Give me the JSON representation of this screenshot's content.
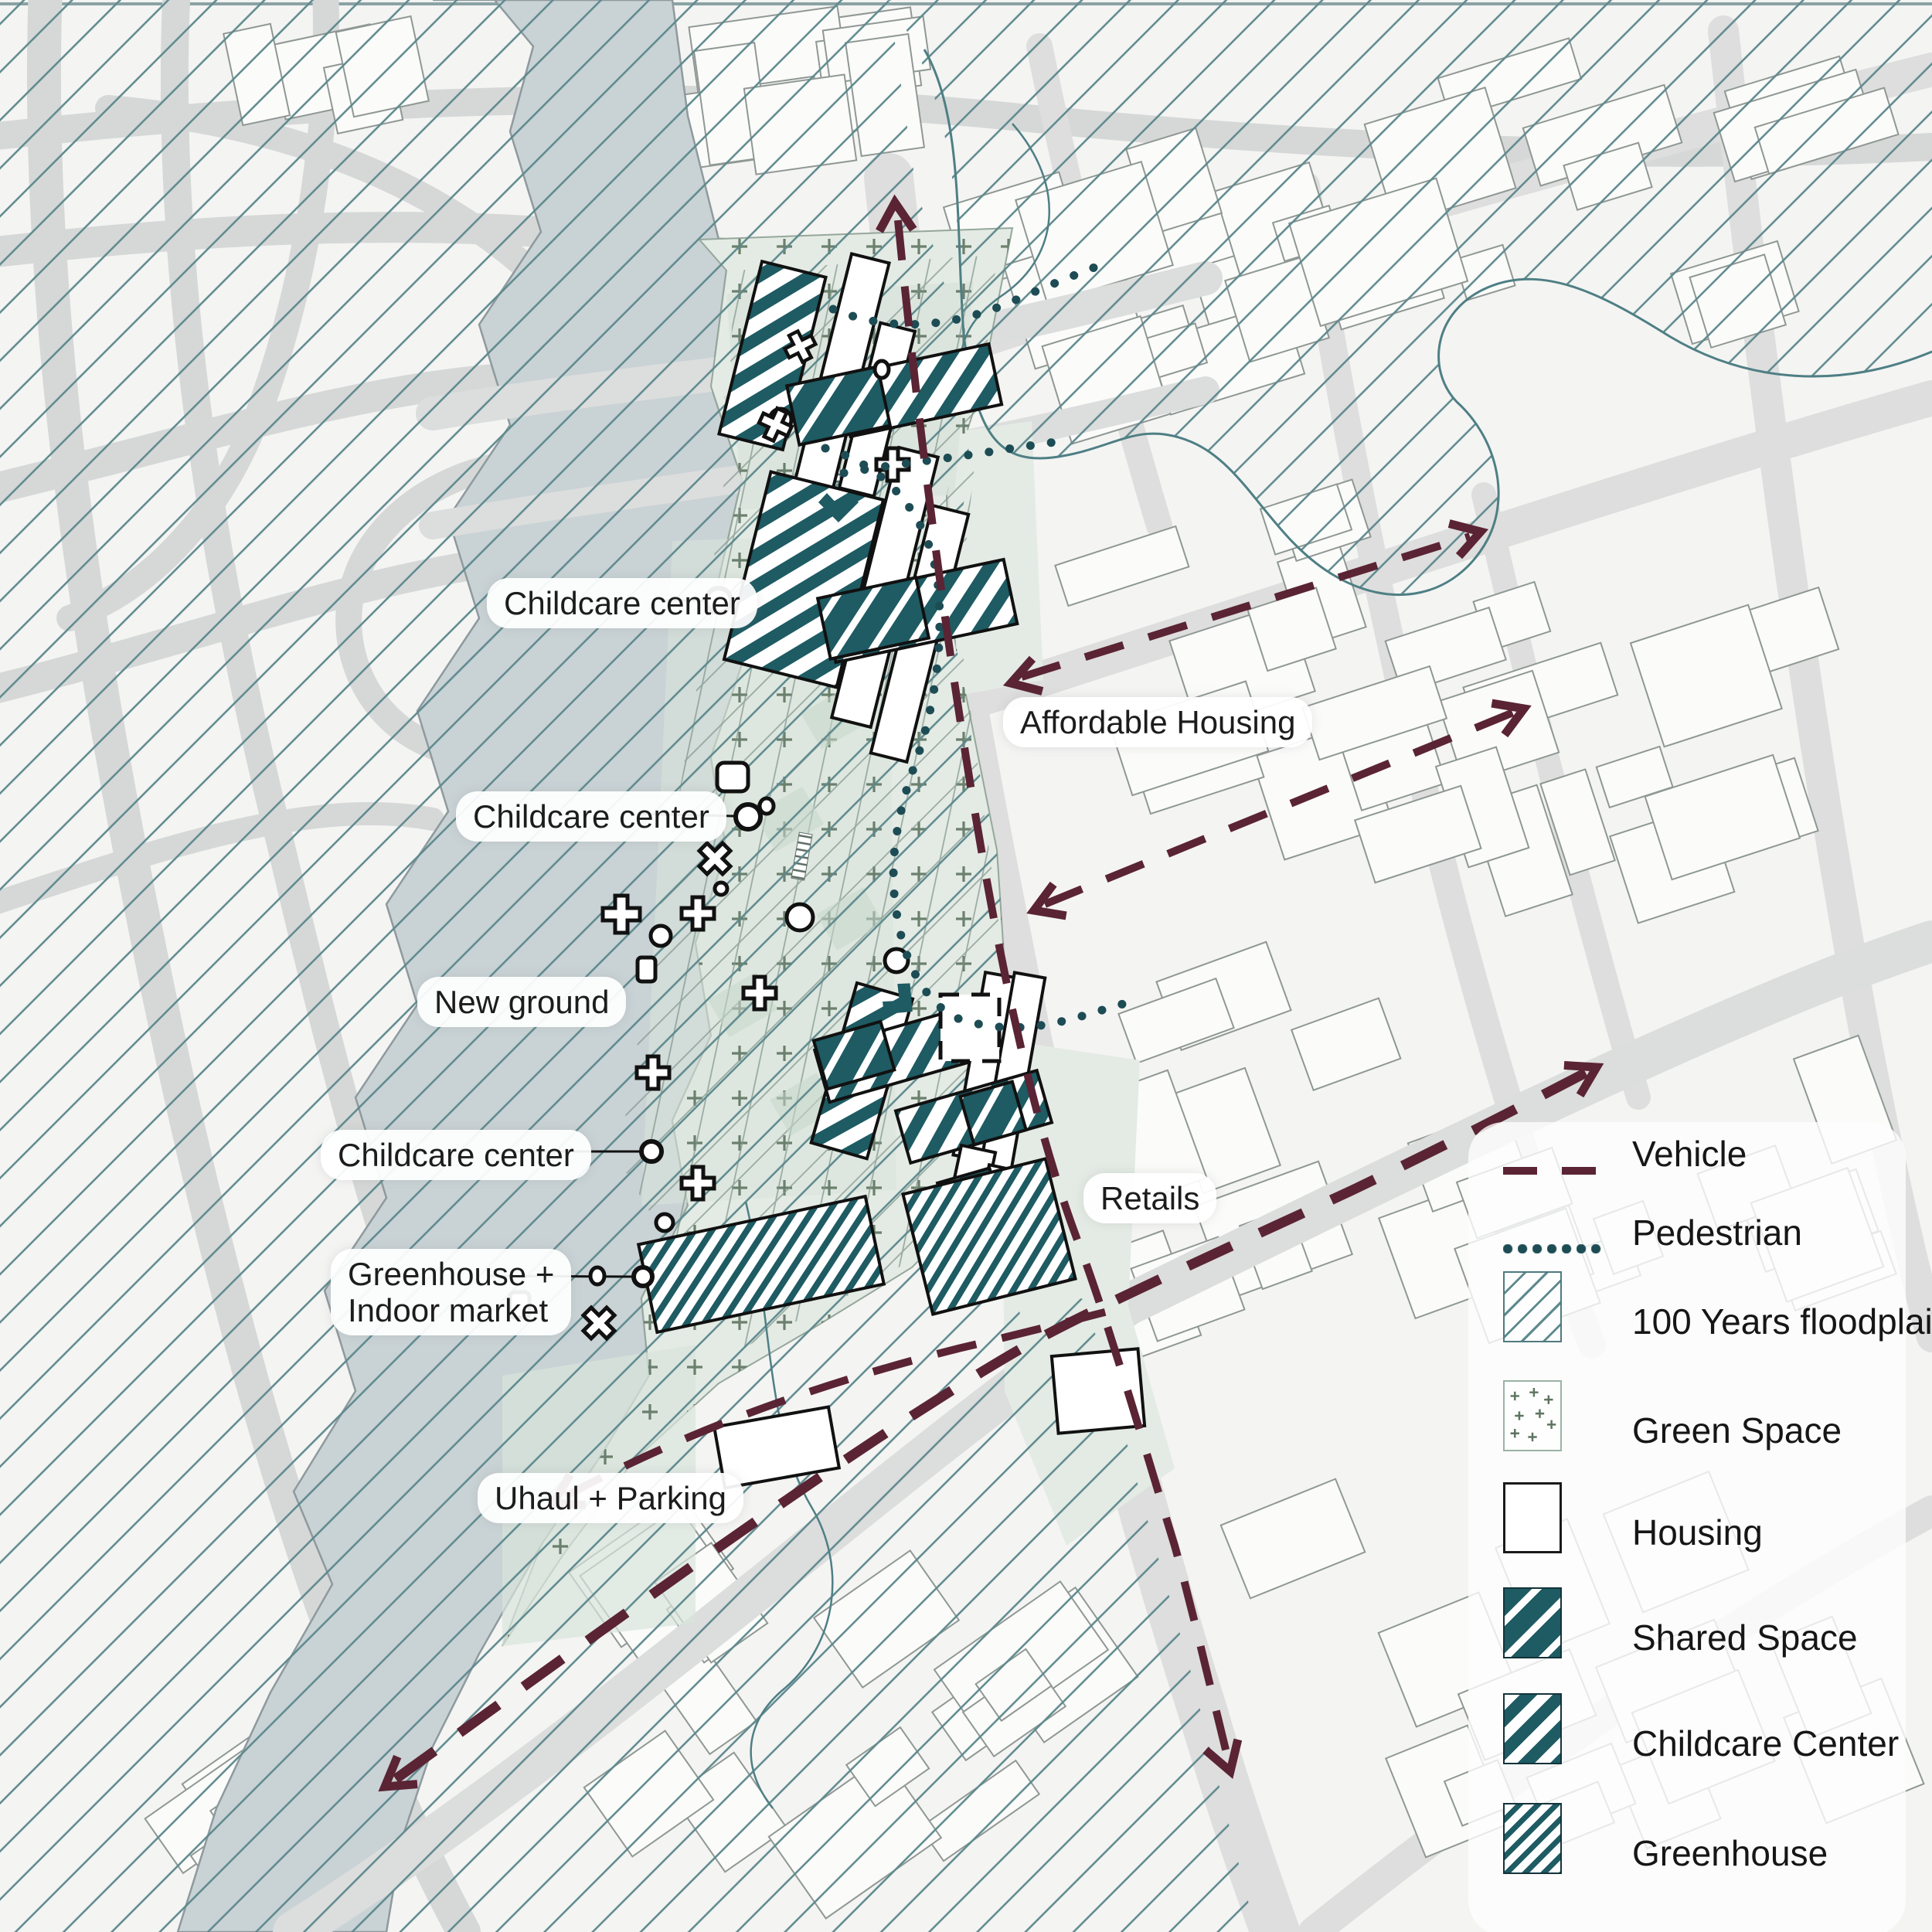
{
  "map_labels": {
    "childcare_1": "Childcare center",
    "childcare_2": "Childcare center",
    "childcare_3": "Childcare center",
    "new_ground": "New ground",
    "greenhouse_line1": "Greenhouse +",
    "greenhouse_line2": "Indoor market",
    "uhaul": "Uhaul + Parking",
    "affordable": "Affordable Housing",
    "retails": "Retails"
  },
  "legend": {
    "items": [
      {
        "type": "dash",
        "icon": "vehicle-dash-icon",
        "label": "Vehicle"
      },
      {
        "type": "dots",
        "icon": "pedestrian-dots-icon",
        "label": "Pedestrian"
      },
      {
        "type": "swatch-flood",
        "icon": "floodplain-swatch-icon",
        "label": "100 Years floodplain"
      },
      {
        "type": "swatch-green",
        "icon": "green-space-swatch-icon",
        "label": "Green Space"
      },
      {
        "type": "swatch-housing",
        "icon": "housing-swatch-icon",
        "label": "Housing"
      },
      {
        "type": "swatch-shared",
        "icon": "shared-space-swatch-icon",
        "label": "Shared Space"
      },
      {
        "type": "swatch-childcare",
        "icon": "childcare-swatch-icon",
        "label": "Childcare Center"
      },
      {
        "type": "swatch-greenhouse",
        "icon": "greenhouse-swatch-icon",
        "label": "Greenhouse"
      }
    ]
  },
  "colors": {
    "accent_teal": "#1e5b63",
    "pedestrian_teal": "#1d4c55",
    "vehicle_maroon": "#5a2434",
    "floodplain_hatch": "#5d898d",
    "river": "#c9d2d5",
    "site_green": "#e4ebe4",
    "site_green_dark": "#d9e4db",
    "green_plus": "#5d7460",
    "road_gray": "#dedede",
    "building_outline": "#8f9894"
  }
}
